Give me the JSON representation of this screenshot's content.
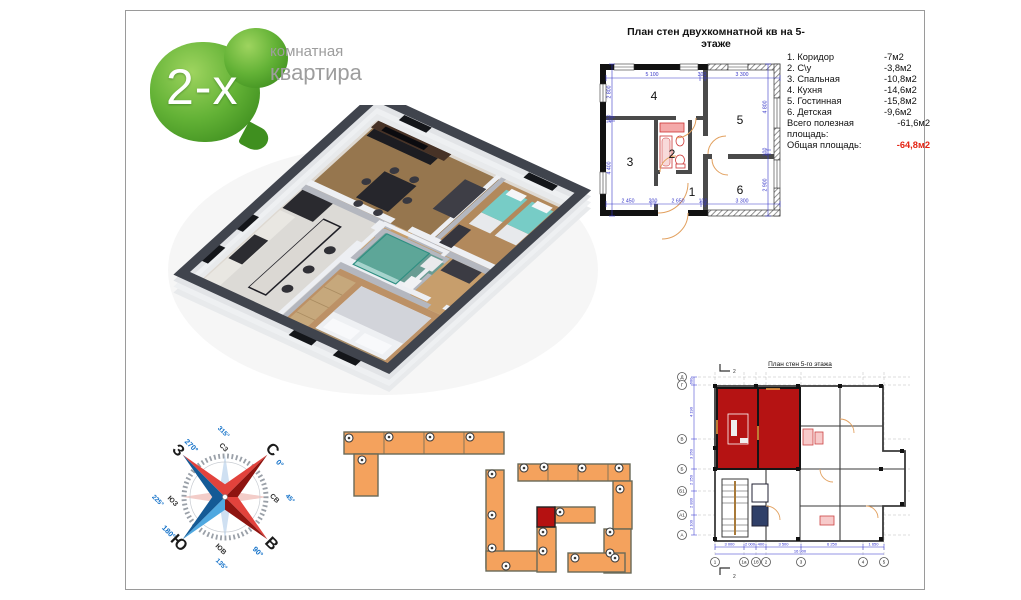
{
  "logo": {
    "number": "2-х",
    "caption_line1": "комнатная",
    "caption_line2": "квартира"
  },
  "main_plan": {
    "title": "План стен двухкомнатной кв на 5-этаже",
    "room_numbers": [
      "1",
      "2",
      "3",
      "4",
      "5",
      "6"
    ],
    "legend": [
      {
        "label": "1. Коридор",
        "area": "-7м2"
      },
      {
        "label": "2. С\\у",
        "area": "-3,8м2"
      },
      {
        "label": "3. Спальная",
        "area": "-10,8м2"
      },
      {
        "label": "4. Кухня",
        "area": "-14,6м2"
      },
      {
        "label": "5. Гостинная",
        "area": "-15,8м2"
      },
      {
        "label": "6. Детская",
        "area": "-9,6м2"
      }
    ],
    "totals": [
      {
        "label": "Всего полезная площадь:",
        "value": "-61,6м2"
      },
      {
        "label": "Общая площадь:",
        "value": "-64,8м2"
      }
    ],
    "dims_top": [
      "5 100",
      "300",
      "3 300"
    ],
    "dims_left": [
      "2 800",
      "100",
      "4 400"
    ],
    "dims_right": [
      "4 800",
      "100",
      "2 900"
    ],
    "dims_bottom": [
      "2 450",
      "200",
      "2 650",
      "100",
      "3 300"
    ]
  },
  "compass": {
    "n": "С",
    "e": "В",
    "s": "Ю",
    "w": "З",
    "ne": "СВ",
    "se": "ЮВ",
    "sw": "ЮЗ",
    "nw": "СЗ",
    "deg_n": "0°",
    "deg_e": "90°",
    "deg_s": "180°",
    "deg_w": "270°",
    "deg_ne": "45°",
    "deg_se": "135°",
    "deg_sw": "225°",
    "deg_nw": "315°"
  },
  "small_plan": {
    "title": "План стен 5-го этажа",
    "axis_left": [
      "Д",
      "Г",
      "В",
      "Б",
      "Б1",
      "А1",
      "А"
    ],
    "axis_bottom": [
      "1",
      "1а",
      "1б",
      "2",
      "3",
      "4",
      "5"
    ],
    "dims_bottom": [
      "3 000",
      "2 000",
      "400",
      "3 500",
      "6 250",
      "1 650"
    ],
    "dims_bottom_total": "16 900",
    "dims_left": [
      "600",
      "4 190",
      "3 260",
      "2 250",
      "2 830",
      "1 100"
    ],
    "section_mark": "2"
  },
  "colors": {
    "accent_red": "#e42313",
    "apartment_red": "#b51313",
    "site_orange": "#f4a25d",
    "dim_blue": "#3838c8"
  }
}
